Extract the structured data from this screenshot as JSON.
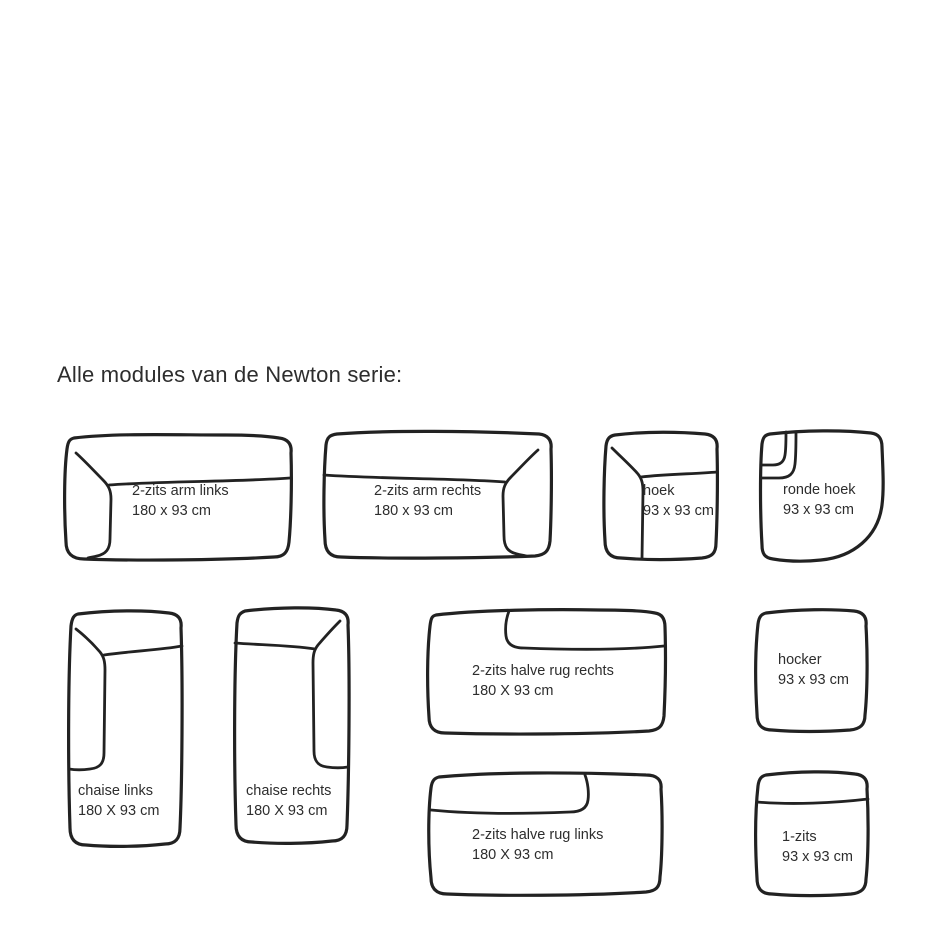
{
  "page": {
    "title": "Alle modules van de Newton serie:"
  },
  "drawing": {
    "stroke_color": "#222222",
    "text_color": "#2d2d2d",
    "background_color": "#ffffff"
  },
  "modules": [
    {
      "id": "2-zits-arm-links",
      "name": "2-zits arm links",
      "size": "180 x 93 cm"
    },
    {
      "id": "2-zits-arm-rechts",
      "name": "2-zits arm rechts",
      "size": "180 x 93 cm"
    },
    {
      "id": "hoek",
      "name": "hoek",
      "size": "93 x 93 cm"
    },
    {
      "id": "ronde-hoek",
      "name": "ronde hoek",
      "size": "93 x 93 cm"
    },
    {
      "id": "chaise-links",
      "name": "chaise links",
      "size": "180 X 93 cm"
    },
    {
      "id": "chaise-rechts",
      "name": "chaise rechts",
      "size": "180 X 93 cm"
    },
    {
      "id": "2-zits-halve-rug-rechts",
      "name": "2-zits halve rug rechts",
      "size": "180 X 93 cm"
    },
    {
      "id": "hocker",
      "name": "hocker",
      "size": "93 x 93 cm"
    },
    {
      "id": "2-zits-halve-rug-links",
      "name": "2-zits halve rug links",
      "size": "180 X 93 cm"
    },
    {
      "id": "1-zits",
      "name": "1-zits",
      "size": "93 x 93 cm"
    }
  ]
}
